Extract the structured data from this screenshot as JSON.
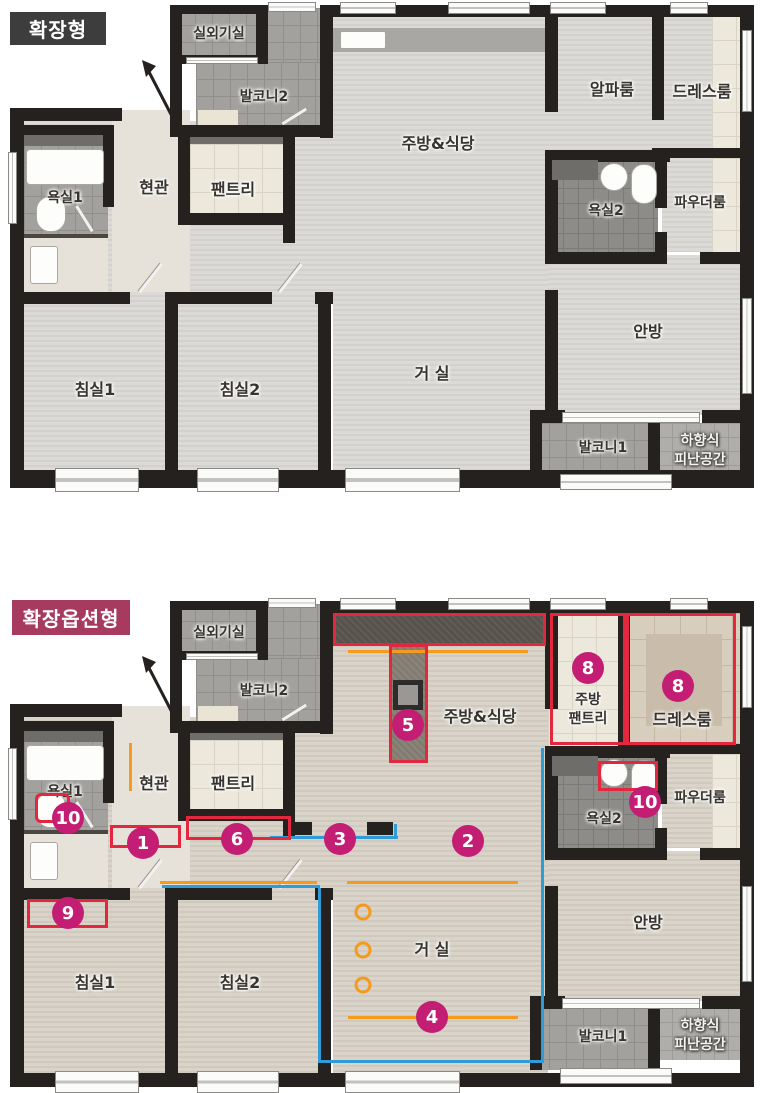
{
  "colors": {
    "badge_extended_bg": "#3d3d3d",
    "badge_option_bg": "#a73a5f",
    "marker": "#c31e73",
    "overlay_red": "#e2273f",
    "overlay_blue": "#2f9cd8",
    "overlay_orange": "#f59a1d",
    "wall": "#24211e"
  },
  "plan_extended": {
    "title": "확장형",
    "rooms": {
      "outdoor_unit": "실외기실",
      "balcony2": "발코니2",
      "kitchen_dining": "주방&식당",
      "alpha_room": "알파룸",
      "dress_room": "드레스룸",
      "bath1": "욕실1",
      "entrance": "현관",
      "pantry": "팬트리",
      "bath2": "욕실2",
      "powder_room": "파우더룸",
      "bedroom1": "침실1",
      "bedroom2": "침실2",
      "living": "거 실",
      "master": "안방",
      "balcony1": "발코니1",
      "evac_line1": "하향식",
      "evac_line2": "피난공간"
    }
  },
  "plan_option": {
    "title": "확장옵션형",
    "rooms": {
      "outdoor_unit": "실외기실",
      "balcony2": "발코니2",
      "kitchen_dining": "주방&식당",
      "kitchen_pantry_line1": "주방",
      "kitchen_pantry_line2": "팬트리",
      "dress_room": "드레스룸",
      "bath1": "욕실1",
      "entrance": "현관",
      "pantry": "팬트리",
      "bath2": "욕실2",
      "powder_room": "파우더룸",
      "bedroom1": "침실1",
      "bedroom2": "침실2",
      "living": "거 실",
      "master": "안방",
      "balcony1": "발코니1",
      "evac_line1": "하향식",
      "evac_line2": "피난공간"
    },
    "markers": {
      "m1": "1",
      "m2": "2",
      "m3": "3",
      "m4": "4",
      "m5": "5",
      "m6": "6",
      "m8a": "8",
      "m8b": "8",
      "m9": "9",
      "m10a": "10",
      "m10b": "10"
    }
  }
}
